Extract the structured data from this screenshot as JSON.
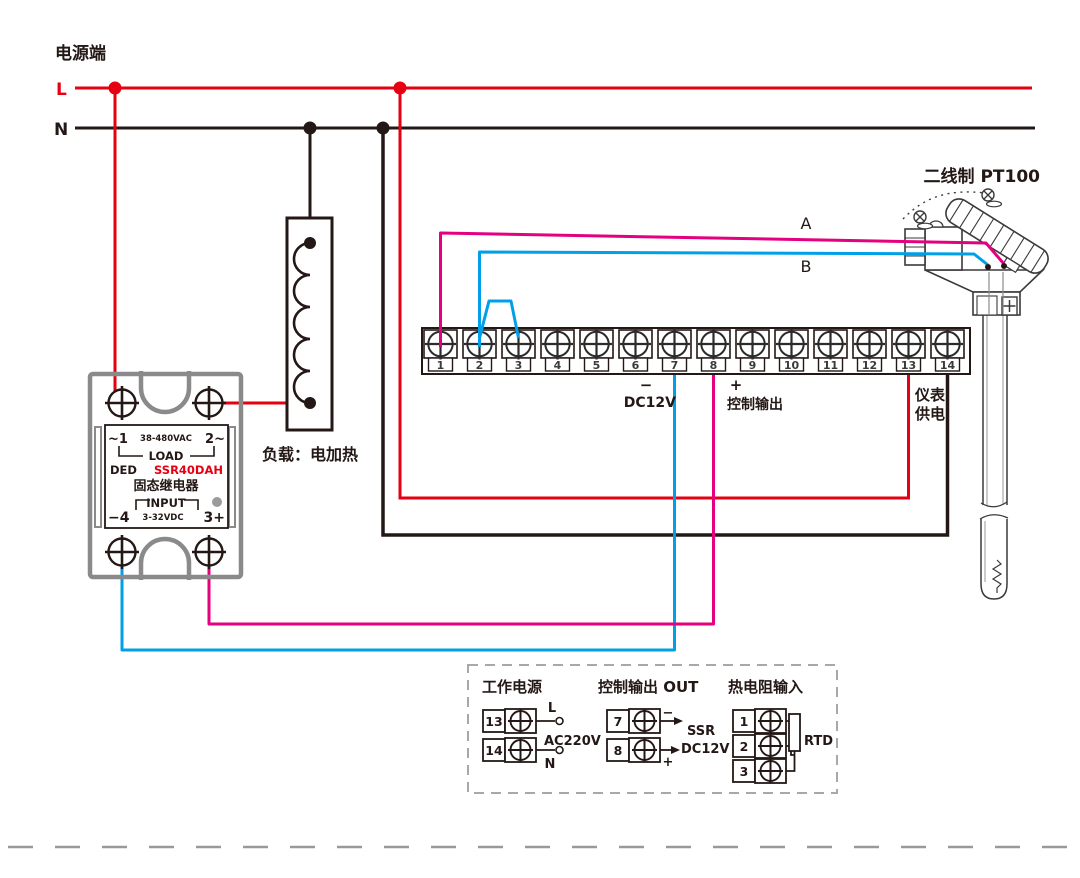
{
  "colors": {
    "line_red": "#e60012",
    "wire_magenta": "#e4007f",
    "wire_blue": "#00a0e9",
    "line_black": "#231815",
    "ssr_gray": "#8a8a8a",
    "dash_gray": "#9b9b9b"
  },
  "power": {
    "title": "电源端",
    "l": "L",
    "n": "N"
  },
  "ssr": {
    "row1_left": "~1",
    "row1_mid": "38-480VAC",
    "row1_right": "2~",
    "load": "LOAD",
    "brand": "DED",
    "model": "SSR40DAH",
    "name": "固态继电器",
    "input": "INPUT",
    "row6_left": "−4",
    "row6_mid": "3-32VDC",
    "row6_right": "3+"
  },
  "load": {
    "caption": "负载：电加热"
  },
  "terminal_block": {
    "terminals": [
      "1",
      "2",
      "3",
      "4",
      "5",
      "6",
      "7",
      "8",
      "9",
      "10",
      "11",
      "12",
      "13",
      "14"
    ],
    "minus": "−",
    "plus": "+",
    "dc12v": "DC12V",
    "control_output": "控制输出",
    "meter_supply_line1": "仪表",
    "meter_supply_line2": "供电"
  },
  "sensor": {
    "title": "二线制 PT100",
    "wire_a": "A",
    "wire_b": "B"
  },
  "legend": {
    "power": {
      "title": "工作电源",
      "t1": "13",
      "t2": "14",
      "l": "L",
      "n": "N",
      "voltage": "AC220V"
    },
    "output": {
      "title": "控制输出 OUT",
      "t1": "7",
      "t2": "8",
      "minus": "−",
      "plus": "+",
      "ssr": "SSR",
      "dc12v": "DC12V"
    },
    "rtd": {
      "title": "热电阻输入",
      "t1": "1",
      "t2": "2",
      "t3": "3",
      "rtd": "RTD"
    }
  }
}
